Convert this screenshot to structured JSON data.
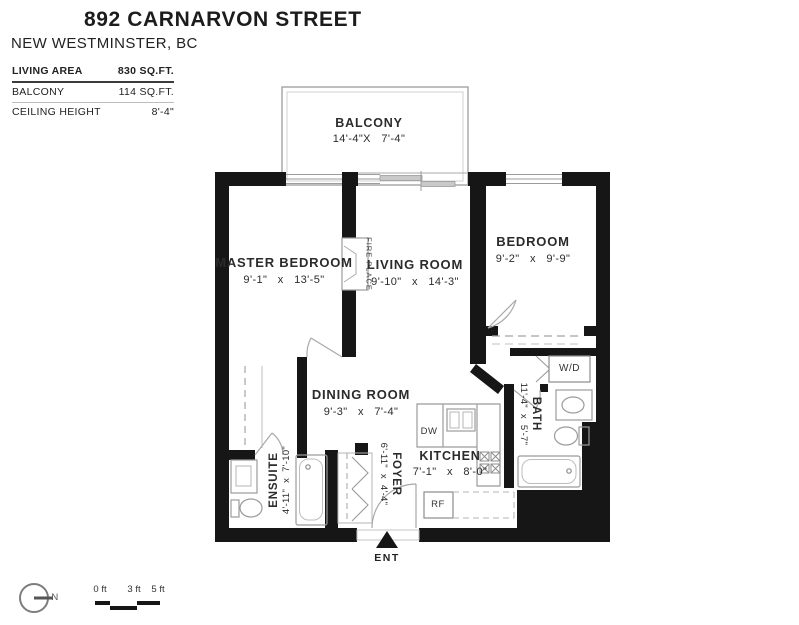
{
  "header": {
    "title": "892 CARNARVON STREET",
    "subtitle": "NEW WESTMINSTER, BC",
    "stats": [
      {
        "label": "LIVING AREA",
        "value": "830 SQ.FT."
      },
      {
        "label": "BALCONY",
        "value": "114 SQ.FT."
      },
      {
        "label": "CEILING HEIGHT",
        "value": "8'-4\""
      }
    ]
  },
  "rooms": {
    "balcony": {
      "name": "BALCONY",
      "dims": "14'-4\"X 7'-4\""
    },
    "master_bedroom": {
      "name": "MASTER BEDROOM",
      "dims": "9'-1\" x 13'-5\""
    },
    "living_room": {
      "name": "LIVING ROOM",
      "dims": "9'-10\" x 14'-3\""
    },
    "bedroom": {
      "name": "BEDROOM",
      "dims": "9'-2\" x 9'-9\""
    },
    "dining_room": {
      "name": "DINING ROOM",
      "dims": "9'-3\" x 7'-4\""
    },
    "kitchen": {
      "name": "KITCHEN",
      "dims": "7'-1\" x 8'-0\""
    },
    "foyer": {
      "name": "FOYER",
      "dims": "6'-11\" x 4'-4\""
    },
    "bath": {
      "name": "BATH",
      "dims": "11'-4\" x 5'-7\""
    },
    "ensuite": {
      "name": "ENSUITE",
      "dims": "4'-11\" x 7'-10\""
    }
  },
  "fixtures": {
    "fireplace": "FIRE PLACE",
    "washer_dryer": "W/D",
    "dishwasher": "DW",
    "refrigerator": "RF",
    "entry": "ENT"
  },
  "legend": {
    "north": "N",
    "scale_ticks": [
      "0 ft",
      "3 ft",
      "5 ft"
    ]
  },
  "colors": {
    "wall": "#161616",
    "line": "#9b9b9b",
    "text": "#2b2b2b"
  }
}
